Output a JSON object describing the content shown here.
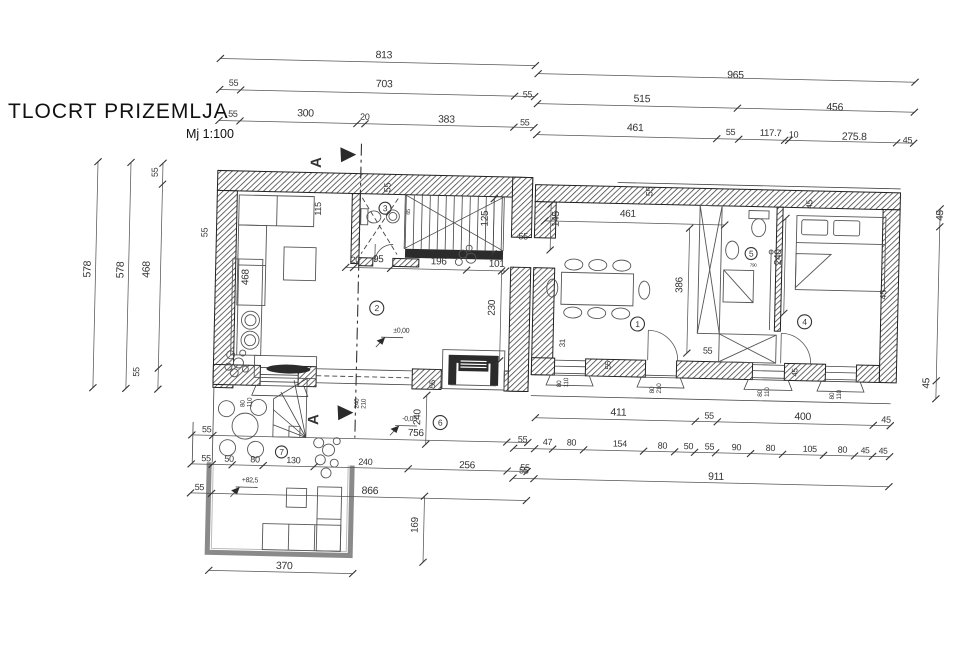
{
  "title": "TLOCRT PRIZEMLJA",
  "scale_label": "Mj 1:100",
  "section_marker_letter": "A",
  "section_markers": [
    {
      "x": 318,
      "y": 168
    },
    {
      "x": 321,
      "y": 425
    }
  ],
  "rooms": [
    {
      "n": "1",
      "x": 638,
      "y": 322,
      "r": 7
    },
    {
      "n": "2",
      "x": 377,
      "y": 312,
      "r": 7
    },
    {
      "n": "3",
      "x": 383,
      "y": 212,
      "r": 6
    },
    {
      "n": "4",
      "x": 805,
      "y": 316,
      "r": 7
    },
    {
      "n": "5",
      "x": 750,
      "y": 249,
      "r": 6
    },
    {
      "n": "6",
      "x": 443,
      "y": 425,
      "r": 7
    },
    {
      "n": "7",
      "x": 285,
      "y": 458,
      "r": 6
    }
  ],
  "elevations": [
    {
      "t": "±0,00",
      "x": 394,
      "y": 336
    },
    {
      "t": "-0,05",
      "x": 405,
      "y": 424
    },
    {
      "t": "+82,5",
      "x": 246,
      "y": 489
    }
  ],
  "windows": [
    {
      "w": "80",
      "h": "110",
      "x": 247,
      "y": 414
    },
    {
      "w": "240",
      "h": "210",
      "x": 361,
      "y": 413
    },
    {
      "w": "80",
      "h": "110",
      "x": 563,
      "y": 387
    },
    {
      "w": "80",
      "h": "210",
      "x": 656,
      "y": 391
    },
    {
      "w": "80",
      "h": "110",
      "x": 764,
      "y": 392
    },
    {
      "w": "80",
      "h": "110",
      "x": 836,
      "y": 393
    }
  ],
  "dim_labels": [
    {
      "t": "813",
      "x": 370,
      "y": 62
    },
    {
      "t": "965",
      "x": 722,
      "y": 74
    },
    {
      "t": "55",
      "x": 224,
      "y": 93,
      "s": 9
    },
    {
      "t": "703",
      "x": 371,
      "y": 91
    },
    {
      "t": "55",
      "x": 518,
      "y": 98,
      "s": 9
    },
    {
      "t": "515",
      "x": 629,
      "y": 100
    },
    {
      "t": "456",
      "x": 822,
      "y": 104
    },
    {
      "t": "55",
      "x": 224,
      "y": 124,
      "s": 9
    },
    {
      "t": "300",
      "x": 293,
      "y": 122
    },
    {
      "t": "20",
      "x": 356,
      "y": 124,
      "s": 9
    },
    {
      "t": "383",
      "x": 434,
      "y": 125
    },
    {
      "t": "55",
      "x": 516,
      "y": 126,
      "s": 9
    },
    {
      "t": "461",
      "x": 623,
      "y": 129
    },
    {
      "t": "55",
      "x": 722,
      "y": 131,
      "s": 9
    },
    {
      "t": "117.7",
      "x": 756,
      "y": 131,
      "s": 9.5
    },
    {
      "t": "10",
      "x": 785,
      "y": 132,
      "s": 9
    },
    {
      "t": "275.8",
      "x": 838,
      "y": 133
    },
    {
      "t": "45",
      "x": 899,
      "y": 135,
      "s": 9
    },
    {
      "t": "578",
      "x": 90,
      "y": 288,
      "r": -90
    },
    {
      "t": "578",
      "x": 123,
      "y": 288,
      "r": -90
    },
    {
      "t": "55",
      "x": 155,
      "y": 186,
      "r": -90,
      "s": 9
    },
    {
      "t": "468",
      "x": 149,
      "y": 287,
      "r": -90
    },
    {
      "t": "55",
      "x": 141,
      "y": 386,
      "r": -90,
      "s": 9
    },
    {
      "t": "55",
      "x": 206,
      "y": 245,
      "r": -90,
      "s": 9
    },
    {
      "t": "115",
      "x": 319,
      "y": 221,
      "r": -90,
      "s": 9
    },
    {
      "t": "468",
      "x": 248,
      "y": 292,
      "r": -90,
      "s": 10
    },
    {
      "t": "55",
      "x": 388,
      "y": 196,
      "r": -90,
      "s": 9
    },
    {
      "t": "65",
      "x": 408,
      "y": 218,
      "r": -90,
      "s": 5.5
    },
    {
      "t": "125",
      "x": 486,
      "y": 228,
      "r": -90,
      "s": 10
    },
    {
      "t": "55",
      "x": 517,
      "y": 240,
      "s": 9
    },
    {
      "t": "20",
      "x": 350,
      "y": 267,
      "s": 8.5
    },
    {
      "t": "95",
      "x": 372,
      "y": 266,
      "s": 10
    },
    {
      "t": "196",
      "x": 430,
      "y": 267,
      "s": 10
    },
    {
      "t": "101",
      "x": 488,
      "y": 268,
      "s": 10
    },
    {
      "t": "230",
      "x": 495,
      "y": 317,
      "r": -90,
      "s": 10
    },
    {
      "t": "55",
      "x": 437,
      "y": 391,
      "r": -90,
      "s": 8
    },
    {
      "t": "461",
      "x": 618,
      "y": 215,
      "s": 10
    },
    {
      "t": "145",
      "x": 557,
      "y": 227,
      "r": -90,
      "s": 10
    },
    {
      "t": "55",
      "x": 650,
      "y": 194,
      "r": -90,
      "s": 9
    },
    {
      "t": "386",
      "x": 682,
      "y": 290,
      "r": -90,
      "s": 10
    },
    {
      "t": "31",
      "x": 566,
      "y": 347,
      "r": -90,
      "s": 8
    },
    {
      "t": "55",
      "x": 704,
      "y": 350,
      "s": 9
    },
    {
      "t": "240",
      "x": 780,
      "y": 260,
      "r": -90,
      "s": 10
    },
    {
      "t": "45",
      "x": 810,
      "y": 203,
      "r": -90,
      "s": 8.5
    },
    {
      "t": "45",
      "x": 886,
      "y": 292,
      "r": -90,
      "s": 9
    },
    {
      "t": "55",
      "x": 612,
      "y": 368,
      "r": -90,
      "s": 8
    },
    {
      "t": "45",
      "x": 799,
      "y": 371,
      "r": -90,
      "s": 8
    },
    {
      "t": "790",
      "x": 749,
      "y": 262,
      "s": 4.5
    },
    {
      "t": "45",
      "x": 941,
      "y": 212,
      "r": -90,
      "s": 10
    },
    {
      "t": "45",
      "x": 931,
      "y": 380,
      "r": -90,
      "s": 10
    },
    {
      "t": "411",
      "x": 613,
      "y": 414
    },
    {
      "t": "55",
      "x": 707,
      "y": 415,
      "s": 9
    },
    {
      "t": "400",
      "x": 797,
      "y": 414
    },
    {
      "t": "45",
      "x": 884,
      "y": 415,
      "s": 9
    },
    {
      "t": "47",
      "x": 546,
      "y": 445,
      "s": 9
    },
    {
      "t": "80",
      "x": 570,
      "y": 445,
      "s": 9
    },
    {
      "t": "154",
      "x": 616,
      "y": 445,
      "s": 9
    },
    {
      "t": "80",
      "x": 661,
      "y": 446,
      "s": 9
    },
    {
      "t": "50",
      "x": 687,
      "y": 446,
      "s": 9
    },
    {
      "t": "55",
      "x": 708,
      "y": 446,
      "s": 9
    },
    {
      "t": "90",
      "x": 735,
      "y": 446,
      "s": 9
    },
    {
      "t": "80",
      "x": 769,
      "y": 446,
      "s": 9
    },
    {
      "t": "105",
      "x": 806,
      "y": 446,
      "s": 9
    },
    {
      "t": "80",
      "x": 841,
      "y": 446,
      "s": 9
    },
    {
      "t": "45",
      "x": 864,
      "y": 446,
      "s": 8.5
    },
    {
      "t": "45",
      "x": 882,
      "y": 446,
      "s": 8.5
    },
    {
      "t": "55",
      "x": 521,
      "y": 443,
      "s": 9
    },
    {
      "t": "55",
      "x": 523,
      "y": 474,
      "s": 9
    },
    {
      "t": "911",
      "x": 712,
      "y": 476
    },
    {
      "t": "55",
      "x": 205,
      "y": 440,
      "s": 9
    },
    {
      "t": "756",
      "x": 411,
      "y": 439,
      "s": 10
    },
    {
      "t": "55",
      "x": 205,
      "y": 469,
      "s": 9
    },
    {
      "t": "50",
      "x": 228,
      "y": 469,
      "s": 9
    },
    {
      "t": "80",
      "x": 254,
      "y": 469,
      "s": 9
    },
    {
      "t": "130",
      "x": 290,
      "y": 469,
      "s": 9
    },
    {
      "t": "240",
      "x": 362,
      "y": 469,
      "s": 9
    },
    {
      "t": "256",
      "x": 463,
      "y": 470,
      "s": 10
    },
    {
      "t": "55",
      "x": 524,
      "y": 471,
      "s": 9
    },
    {
      "t": "55",
      "x": 199,
      "y": 498,
      "s": 9
    },
    {
      "t": "866",
      "x": 366,
      "y": 498
    },
    {
      "t": "370",
      "x": 282,
      "y": 575
    },
    {
      "t": "240",
      "x": 423,
      "y": 428,
      "r": -90,
      "s": 10
    },
    {
      "t": "169",
      "x": 423,
      "y": 536,
      "r": -90,
      "s": 10
    }
  ]
}
